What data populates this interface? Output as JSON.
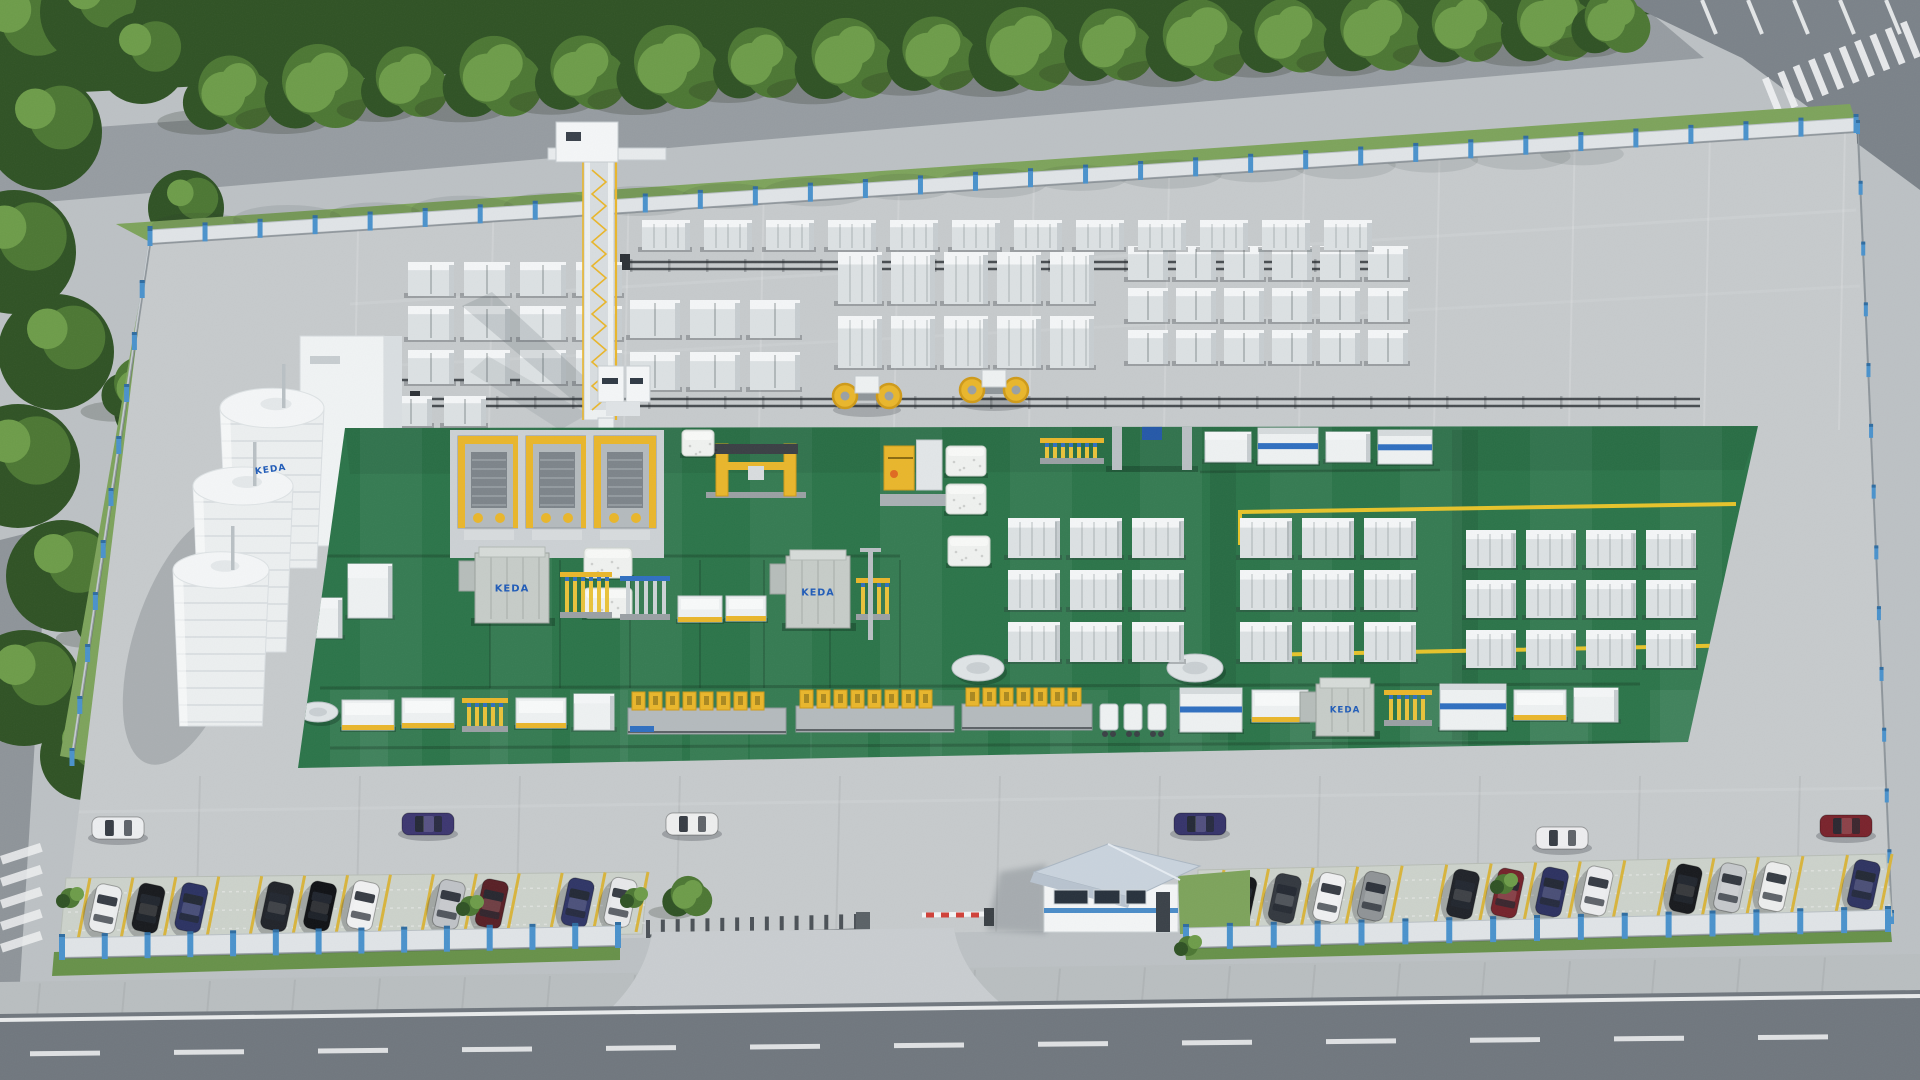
{
  "scene": {
    "title": "Aerial 3D rendering of a fenced AAC block factory compound with silos, gantry crane, green production floor, block stock yard, parking rows, gatehouse and main road",
    "logo_text": "KEDA",
    "colors": {
      "concrete": "#c6cacc",
      "concrete_light": "#d3d7d9",
      "concrete_dark": "#b0b5b8",
      "asphalt": "#70777e",
      "asphalt_light": "#7b8289",
      "road_line": "#e9ebec",
      "sidewalk": "#b9bec0",
      "paver": "#ccd2cb",
      "grass": "#7da35b",
      "grass_dark": "#679149",
      "tree_dark": "#2f5224",
      "tree_mid": "#4c7733",
      "tree_light": "#6d9c49",
      "green_floor": "#2b7449",
      "green_floor_dark": "#225e3b",
      "fence_panel": "#e0e4e7",
      "fence_post": "#4a92cc",
      "white_box": "#eef1f2",
      "box_top": "#f4f6f7",
      "box_shade": "#c7cdd0",
      "machine_gray": "#b4babd",
      "dark_steel": "#3a4045",
      "yellow": "#e9b62b",
      "yellow_deep": "#cf9a18",
      "blue": "#2f6fc0",
      "blue_deep": "#1f5bb8",
      "roof": "#c9d3dd",
      "barrier_red": "#d04038",
      "shadow": "rgba(40,48,55,0.20)"
    },
    "top_trees": [
      {
        "x": 230,
        "y": 96,
        "r": 44
      },
      {
        "x": 318,
        "y": 90,
        "r": 50
      },
      {
        "x": 406,
        "y": 85,
        "r": 42
      },
      {
        "x": 494,
        "y": 80,
        "r": 48
      },
      {
        "x": 582,
        "y": 76,
        "r": 44
      },
      {
        "x": 670,
        "y": 71,
        "r": 50
      },
      {
        "x": 758,
        "y": 66,
        "r": 42
      },
      {
        "x": 846,
        "y": 62,
        "r": 48
      },
      {
        "x": 934,
        "y": 57,
        "r": 44
      },
      {
        "x": 1022,
        "y": 53,
        "r": 50
      },
      {
        "x": 1110,
        "y": 48,
        "r": 43
      },
      {
        "x": 1198,
        "y": 44,
        "r": 49
      },
      {
        "x": 1286,
        "y": 39,
        "r": 44
      },
      {
        "x": 1374,
        "y": 35,
        "r": 47
      },
      {
        "x": 1462,
        "y": 30,
        "r": 42
      },
      {
        "x": 1550,
        "y": 26,
        "r": 46
      },
      {
        "x": 1612,
        "y": 24,
        "r": 38
      }
    ],
    "left_tree_blobs": [
      [
        18,
        36,
        66
      ],
      [
        92,
        12,
        52
      ],
      [
        44,
        132,
        58
      ],
      [
        14,
        252,
        62
      ],
      [
        56,
        352,
        58
      ],
      [
        18,
        466,
        62
      ],
      [
        62,
        576,
        56
      ],
      [
        24,
        688,
        58
      ],
      [
        84,
        756,
        44
      ],
      [
        142,
        58,
        46
      ],
      [
        150,
        410,
        36
      ],
      [
        112,
        618,
        34
      ],
      [
        186,
        208,
        38
      ]
    ],
    "fences": {
      "back": {
        "x1": 150,
        "y1": 230,
        "x2": 1856,
        "y2": 118,
        "posts": 31
      },
      "left": {
        "x1": 150,
        "y1": 232,
        "x2": 72,
        "y2": 752,
        "posts": 10
      },
      "right": {
        "x1": 1858,
        "y1": 124,
        "x2": 1892,
        "y2": 914,
        "posts": 13
      },
      "front_left": {
        "x1": 62,
        "y1": 938,
        "x2": 618,
        "y2": 926,
        "posts": 13
      },
      "front_right": {
        "x1": 1186,
        "y1": 928,
        "x2": 1888,
        "y2": 910,
        "posts": 16
      }
    },
    "stack_clusters": [
      {
        "x": 408,
        "y": 262,
        "cols": 4,
        "rows": 3,
        "cw": 46,
        "ch": 34,
        "gx": 10,
        "gy": 10,
        "style": "cube"
      },
      {
        "x": 630,
        "y": 300,
        "cols": 3,
        "rows": 2,
        "cw": 50,
        "ch": 38,
        "gx": 10,
        "gy": 14,
        "style": "cube"
      },
      {
        "x": 838,
        "y": 252,
        "cols": 5,
        "rows": 2,
        "cw": 44,
        "ch": 52,
        "gx": 9,
        "gy": 12,
        "style": "slab"
      },
      {
        "x": 1128,
        "y": 246,
        "cols": 6,
        "rows": 3,
        "cw": 40,
        "ch": 34,
        "gx": 8,
        "gy": 8,
        "style": "cube"
      },
      {
        "x": 642,
        "y": 220,
        "cols": 12,
        "rows": 1,
        "cw": 48,
        "ch": 30,
        "gx": 14,
        "gy": 0,
        "style": "slab"
      },
      {
        "x": 336,
        "y": 396,
        "cols": 3,
        "rows": 1,
        "cw": 42,
        "ch": 30,
        "gx": 12,
        "gy": 12,
        "style": "cube"
      }
    ],
    "sheds": [
      [
        305,
        445,
        36,
        40
      ],
      [
        314,
        494,
        30,
        34
      ],
      [
        392,
        452,
        34,
        56
      ],
      [
        438,
        472,
        30,
        40
      ],
      [
        458,
        502,
        44,
        34
      ]
    ],
    "clamps": [
      {
        "x": 845,
        "y": 376
      },
      {
        "x": 972,
        "y": 370
      }
    ],
    "rails": [
      {
        "x1": 420,
        "y": 399,
        "x2": 1700,
        "double": true
      },
      {
        "x1": 630,
        "y": 262,
        "x2": 1398,
        "double": true
      },
      {
        "x1": 368,
        "y": 380,
        "x2": 560,
        "double": false
      },
      {
        "x1": 332,
        "y": 458,
        "x2": 620,
        "double": false
      }
    ],
    "silos": [
      {
        "cx": 272,
        "top": 408,
        "rx": 52,
        "bottom": 568
      },
      {
        "cx": 243,
        "top": 486,
        "rx": 50,
        "bottom": 652
      },
      {
        "cx": 221,
        "top": 570,
        "rx": 48,
        "bottom": 726
      }
    ],
    "green_floor_poly": "345,428 1758,426 1688,742 298,768",
    "yellow_lines": [
      "1240,545 1240,512 1736,504",
      "1258,622 1258,655 1752,645"
    ],
    "cutters": {
      "xs": [
        458,
        526,
        594
      ],
      "y": 430
    },
    "yellow_gantry": {
      "x": 716,
      "y": 444,
      "w": 80,
      "h": 52
    },
    "yellow_tilter": {
      "x": 884,
      "y": 440,
      "w": 58,
      "h": 64
    },
    "cakes": [
      [
        946,
        446,
        40,
        30
      ],
      [
        946,
        484,
        40,
        30
      ],
      [
        948,
        536,
        42,
        30
      ],
      [
        584,
        548,
        48,
        30
      ],
      [
        584,
        588,
        48,
        30
      ],
      [
        682,
        430,
        32,
        26
      ]
    ],
    "discs": [
      {
        "cx": 978,
        "cy": 668,
        "rx": 26,
        "ry": 13
      },
      {
        "cx": 1195,
        "cy": 668,
        "rx": 28,
        "ry": 14
      },
      {
        "cx": 318,
        "cy": 712,
        "rx": 20,
        "ry": 10
      },
      {
        "cx": 282,
        "cy": 652,
        "rx": 18,
        "ry": 9
      }
    ],
    "right_top_machines": [
      {
        "t": "combV",
        "x": 1040,
        "y": 438,
        "w": 64,
        "h": 26
      },
      {
        "t": "blueGantry",
        "x": 1112,
        "y": 416,
        "w": 80,
        "h": 54
      },
      {
        "t": "box",
        "x": 1205,
        "y": 432,
        "w": 46,
        "h": 30
      },
      {
        "t": "machineB",
        "x": 1258,
        "y": 428,
        "w": 60,
        "h": 36
      },
      {
        "t": "box",
        "x": 1326,
        "y": 432,
        "w": 44,
        "h": 30
      },
      {
        "t": "machineB",
        "x": 1378,
        "y": 430,
        "w": 54,
        "h": 34
      }
    ],
    "green_stack_grids": [
      {
        "x": 1008,
        "step": 62,
        "cols": 3,
        "rows": [
          518,
          570,
          622
        ],
        "w": 52,
        "h": 40
      },
      {
        "x": 1240,
        "step": 62,
        "cols": 3,
        "rows": [
          518,
          570,
          622
        ],
        "w": 52,
        "h": 40
      },
      {
        "x": 1466,
        "step": 60,
        "cols": 4,
        "rows": [
          530,
          580,
          630
        ],
        "w": 50,
        "h": 38
      }
    ],
    "line_a_items": [
      {
        "t": "rackV",
        "x": 258,
        "y": 570,
        "w": 26,
        "h": 62
      },
      {
        "t": "box",
        "x": 306,
        "y": 598,
        "w": 36,
        "h": 40
      },
      {
        "t": "box",
        "x": 348,
        "y": 564,
        "w": 44,
        "h": 54
      },
      {
        "t": "keda",
        "x": 475,
        "y": 553,
        "w": 74,
        "h": 70
      },
      {
        "t": "comb",
        "x": 560,
        "y": 572,
        "w": 52,
        "h": 46
      },
      {
        "t": "combB",
        "x": 620,
        "y": 576,
        "w": 50,
        "h": 44
      },
      {
        "t": "table",
        "x": 678,
        "y": 596,
        "w": 44,
        "h": 26
      },
      {
        "t": "table",
        "x": 726,
        "y": 596,
        "w": 40,
        "h": 25
      },
      {
        "t": "keda",
        "x": 786,
        "y": 556,
        "w": 64,
        "h": 72
      },
      {
        "t": "comb",
        "x": 856,
        "y": 578,
        "w": 34,
        "h": 42
      },
      {
        "t": "pole",
        "x": 868,
        "y": 548
      }
    ],
    "line_b_items": [
      {
        "t": "table",
        "x": 342,
        "y": 700,
        "w": 52,
        "h": 30
      },
      {
        "t": "table",
        "x": 402,
        "y": 698,
        "w": 52,
        "h": 30
      },
      {
        "t": "comb",
        "x": 462,
        "y": 698,
        "w": 46,
        "h": 34
      },
      {
        "t": "table",
        "x": 516,
        "y": 698,
        "w": 50,
        "h": 30
      },
      {
        "t": "box",
        "x": 574,
        "y": 694,
        "w": 40,
        "h": 36
      },
      {
        "t": "moulds",
        "x": 628,
        "y": 692,
        "w": 158,
        "h": 46
      },
      {
        "t": "moulds",
        "x": 796,
        "y": 690,
        "w": 158,
        "h": 46
      },
      {
        "t": "moulds",
        "x": 962,
        "y": 688,
        "w": 130,
        "h": 46
      },
      {
        "t": "carts",
        "x": 1100,
        "y": 700,
        "w": 70,
        "h": 40
      },
      {
        "t": "machineB",
        "x": 1180,
        "y": 688,
        "w": 62,
        "h": 44
      },
      {
        "t": "table",
        "x": 1252,
        "y": 690,
        "w": 56,
        "h": 32
      },
      {
        "t": "keda",
        "x": 1316,
        "y": 684,
        "w": 58,
        "h": 52
      },
      {
        "t": "comb",
        "x": 1384,
        "y": 690,
        "w": 48,
        "h": 36
      },
      {
        "t": "machineB",
        "x": 1440,
        "y": 684,
        "w": 66,
        "h": 46
      },
      {
        "t": "table",
        "x": 1514,
        "y": 690,
        "w": 52,
        "h": 30
      },
      {
        "t": "box",
        "x": 1574,
        "y": 688,
        "w": 44,
        "h": 34
      }
    ],
    "apron_cars": [
      {
        "x": 118,
        "y": 828,
        "color": "#eceef0"
      },
      {
        "x": 428,
        "y": 824,
        "color": "#3c3670"
      },
      {
        "x": 692,
        "y": 824,
        "color": "#edeeee"
      },
      {
        "x": 1200,
        "y": 824,
        "color": "#35336a"
      },
      {
        "x": 1562,
        "y": 838,
        "color": "#ededef"
      },
      {
        "x": 1846,
        "y": 826,
        "color": "#79222b"
      }
    ],
    "parking_left": {
      "poly": "66,878 648,872 642,934 60,942",
      "x1": 78,
      "yTop1": 878,
      "yBot1": 940,
      "x2": 636,
      "yTop2": 872,
      "yBot2": 932,
      "stalls": 13,
      "cars": [
        {
          "slot": 0,
          "color": "#ebedee"
        },
        {
          "slot": 1,
          "color": "#17191d"
        },
        {
          "slot": 2,
          "color": "#2b3262"
        },
        {
          "slot": 4,
          "color": "#202329"
        },
        {
          "slot": 5,
          "color": "#0f1115"
        },
        {
          "slot": 6,
          "color": "#f0f1f2"
        },
        {
          "slot": 8,
          "color": "#bfc2c6"
        },
        {
          "slot": 9,
          "color": "#581f25"
        },
        {
          "slot": 11,
          "color": "#2f3566"
        },
        {
          "slot": 12,
          "color": "#e7e8ea"
        }
      ],
      "bushes": [
        [
          70,
          898
        ],
        [
          470,
          906
        ],
        [
          634,
          898
        ]
      ]
    },
    "parking_right": {
      "poly": "1198,870 1886,854 1892,916 1196,932",
      "x1": 1212,
      "yTop1": 870,
      "yBot1": 930,
      "x2": 1880,
      "yTop2": 854,
      "yBot2": 914,
      "stalls": 15,
      "cars": [
        {
          "slot": 0,
          "color": "#141619"
        },
        {
          "slot": 1,
          "color": "#33383f"
        },
        {
          "slot": 2,
          "color": "#eff0f1"
        },
        {
          "slot": 3,
          "color": "#8f9396"
        },
        {
          "slot": 5,
          "color": "#1f2228"
        },
        {
          "slot": 6,
          "color": "#74222a"
        },
        {
          "slot": 7,
          "color": "#2c3160"
        },
        {
          "slot": 8,
          "color": "#ebecee"
        },
        {
          "slot": 10,
          "color": "#17191d"
        },
        {
          "slot": 11,
          "color": "#c5c8cb"
        },
        {
          "slot": 12,
          "color": "#eceded"
        },
        {
          "slot": 14,
          "color": "#2e3361"
        }
      ],
      "bushes": [
        [
          1504,
          884
        ]
      ]
    },
    "gate": {
      "accordion_x1": 648,
      "accordion_y1": 926,
      "accordion_x2": 856,
      "accordion_y2": 920,
      "pickets": 15,
      "barrier_x": 984,
      "barrier_y": 908,
      "arm_len": 62,
      "red_segs": 4
    },
    "road": {
      "edge_y_left": 1020,
      "edge_y_right": 996,
      "dash_y_left": 1054,
      "dash_y_right": 1036,
      "dash_count": 13,
      "dash_len": 70,
      "dash_gap": 74
    },
    "crosswalk_tr": {
      "stripes": 10,
      "x1": 1772,
      "y1": 96,
      "x2": 1910,
      "y2": 40
    },
    "stall_ticks_tr": 5,
    "zebra_bl": 5
  }
}
